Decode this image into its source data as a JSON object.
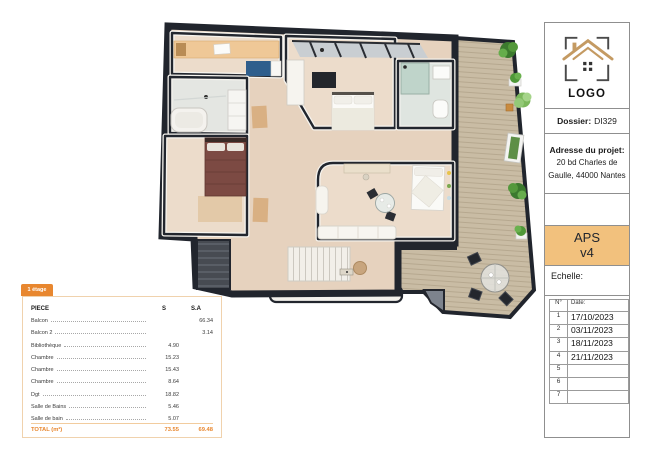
{
  "palette": {
    "accent_orange": "#E8872F",
    "aps_box_orange": "#F2C17D",
    "wall_dark": "#22262E",
    "deck_wood": "#C9BCA4",
    "room_floor": "#EBD9C8",
    "hall_floor": "#E6D2BE",
    "plant_green": "#4F9838"
  },
  "area_table": {
    "tab": "1 étage",
    "columns": {
      "piece": "PIECE",
      "s": "S",
      "sa": "S.A"
    },
    "rows": [
      {
        "name": "Balcon",
        "s": "",
        "sa": "66.34"
      },
      {
        "name": "Balcon 2",
        "s": "",
        "sa": "3.14"
      },
      {
        "name": "Bibliothèque",
        "s": "4.90",
        "sa": ""
      },
      {
        "name": "Chambre",
        "s": "15.23",
        "sa": ""
      },
      {
        "name": "Chambre",
        "s": "15.43",
        "sa": ""
      },
      {
        "name": "Chambre",
        "s": "8.64",
        "sa": ""
      },
      {
        "name": "Dgt",
        "s": "18.82",
        "sa": ""
      },
      {
        "name": "Salle de Bains",
        "s": "5.46",
        "sa": ""
      },
      {
        "name": "Salle de bain",
        "s": "5.07",
        "sa": ""
      }
    ],
    "total": {
      "label": "TOTAL (m²)",
      "s": "73.55",
      "sa": "69.48"
    }
  },
  "title_block": {
    "logo_text": "LOGO",
    "dossier_label": "Dossier:",
    "dossier_value": "DI329",
    "address_label": "Adresse du projet:",
    "address_value": "20 bd Charles de Gaulle, 44000 Nantes",
    "phase": "APS",
    "version": "v4",
    "scale_label": "Echelle:",
    "dates": {
      "col_num": "N°",
      "col_date": "Date:",
      "rows": [
        {
          "num": "1",
          "date": "17/10/2023"
        },
        {
          "num": "2",
          "date": "03/11/2023"
        },
        {
          "num": "3",
          "date": "18/11/2023"
        },
        {
          "num": "4",
          "date": "21/11/2023"
        },
        {
          "num": "5",
          "date": ""
        },
        {
          "num": "6",
          "date": ""
        },
        {
          "num": "7",
          "date": ""
        }
      ]
    }
  }
}
